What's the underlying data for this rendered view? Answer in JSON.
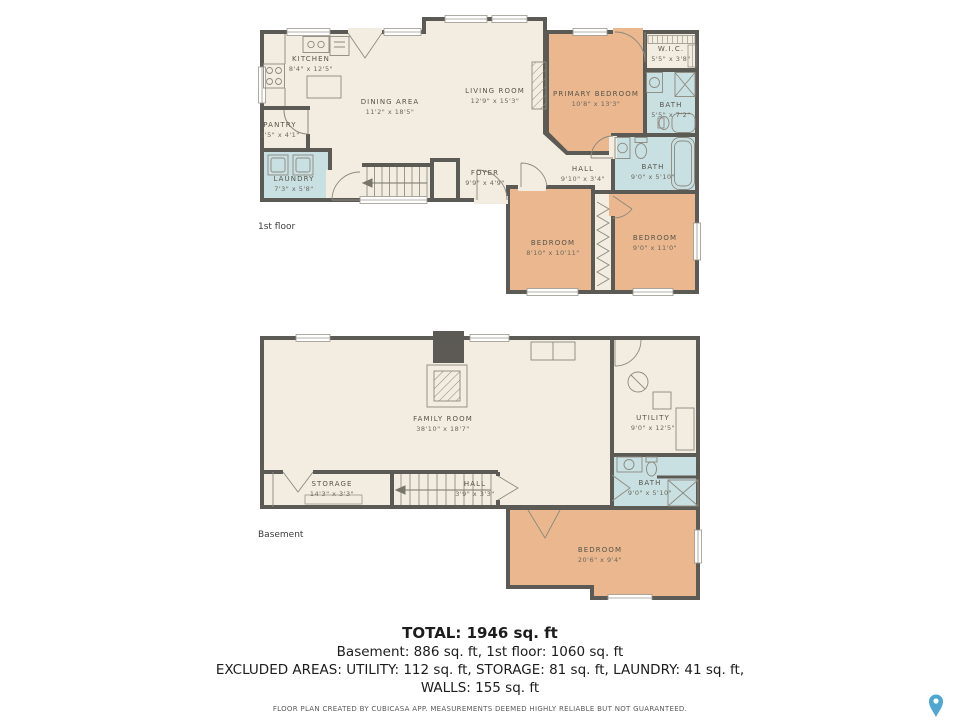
{
  "colors": {
    "room_cream": "#f3ece1",
    "bedroom_tan": "#eab78e",
    "bath_blue": "#c9e0e3",
    "wall_gray": "#5c5a54",
    "pin_teal": "#4ea6d2"
  },
  "first_floor": {
    "floor_label": "1st floor",
    "rooms": {
      "kitchen": {
        "name": "KITCHEN",
        "dims": "8'4\" x 12'5\""
      },
      "dining": {
        "name": "DINING AREA",
        "dims": "11'2\" x 18'5\""
      },
      "living": {
        "name": "LIVING ROOM",
        "dims": "12'9\" x 15'3\""
      },
      "pantry": {
        "name": "PANTRY",
        "dims": "3'5\" x 4'1\""
      },
      "laundry": {
        "name": "LAUNDRY",
        "dims": "7'3\" x 5'8\""
      },
      "foyer": {
        "name": "FOYER",
        "dims": "9'9\" x 4'9\""
      },
      "primary_bedroom": {
        "name": "PRIMARY BEDROOM",
        "dims": "10'8\" x 13'3\""
      },
      "wic": {
        "name": "W.I.C.",
        "dims": "5'5\" x 3'8\""
      },
      "bath_small": {
        "name": "BATH",
        "dims": "5'5\" x 7'2\""
      },
      "hall": {
        "name": "HALL",
        "dims": "9'10\" x 3'4\""
      },
      "bath_main": {
        "name": "BATH",
        "dims": "9'0\" x 5'10\""
      },
      "bedroom1": {
        "name": "BEDROOM",
        "dims": "8'10\" x 10'11\""
      },
      "bedroom2": {
        "name": "BEDROOM",
        "dims": "9'0\" x 11'0\""
      }
    }
  },
  "basement": {
    "floor_label": "Basement",
    "rooms": {
      "family": {
        "name": "FAMILY ROOM",
        "dims": "38'10\" x 18'7\""
      },
      "utility": {
        "name": "UTILITY",
        "dims": "9'0\" x 12'5\""
      },
      "storage": {
        "name": "STORAGE",
        "dims": "14'3\" x 3'3\""
      },
      "hall": {
        "name": "HALL",
        "dims": "3'9\" x 3'3\""
      },
      "bath": {
        "name": "BATH",
        "dims": "9'0\" x 5'10\""
      },
      "bedroom": {
        "name": "BEDROOM",
        "dims": "20'6\" x 9'4\""
      }
    }
  },
  "summary": {
    "total": "TOTAL: 1946 sq. ft",
    "floors_line": "Basement: 886 sq. ft, 1st floor: 1060 sq. ft",
    "excluded_line1": "EXCLUDED AREAS: UTILITY: 112 sq. ft, STORAGE: 81 sq. ft, LAUNDRY: 41 sq. ft,",
    "excluded_line2": "WALLS: 155 sq. ft",
    "footer": "FLOOR PLAN CREATED BY CUBICASA APP. MEASUREMENTS DEEMED HIGHLY RELIABLE BUT NOT GUARANTEED."
  }
}
